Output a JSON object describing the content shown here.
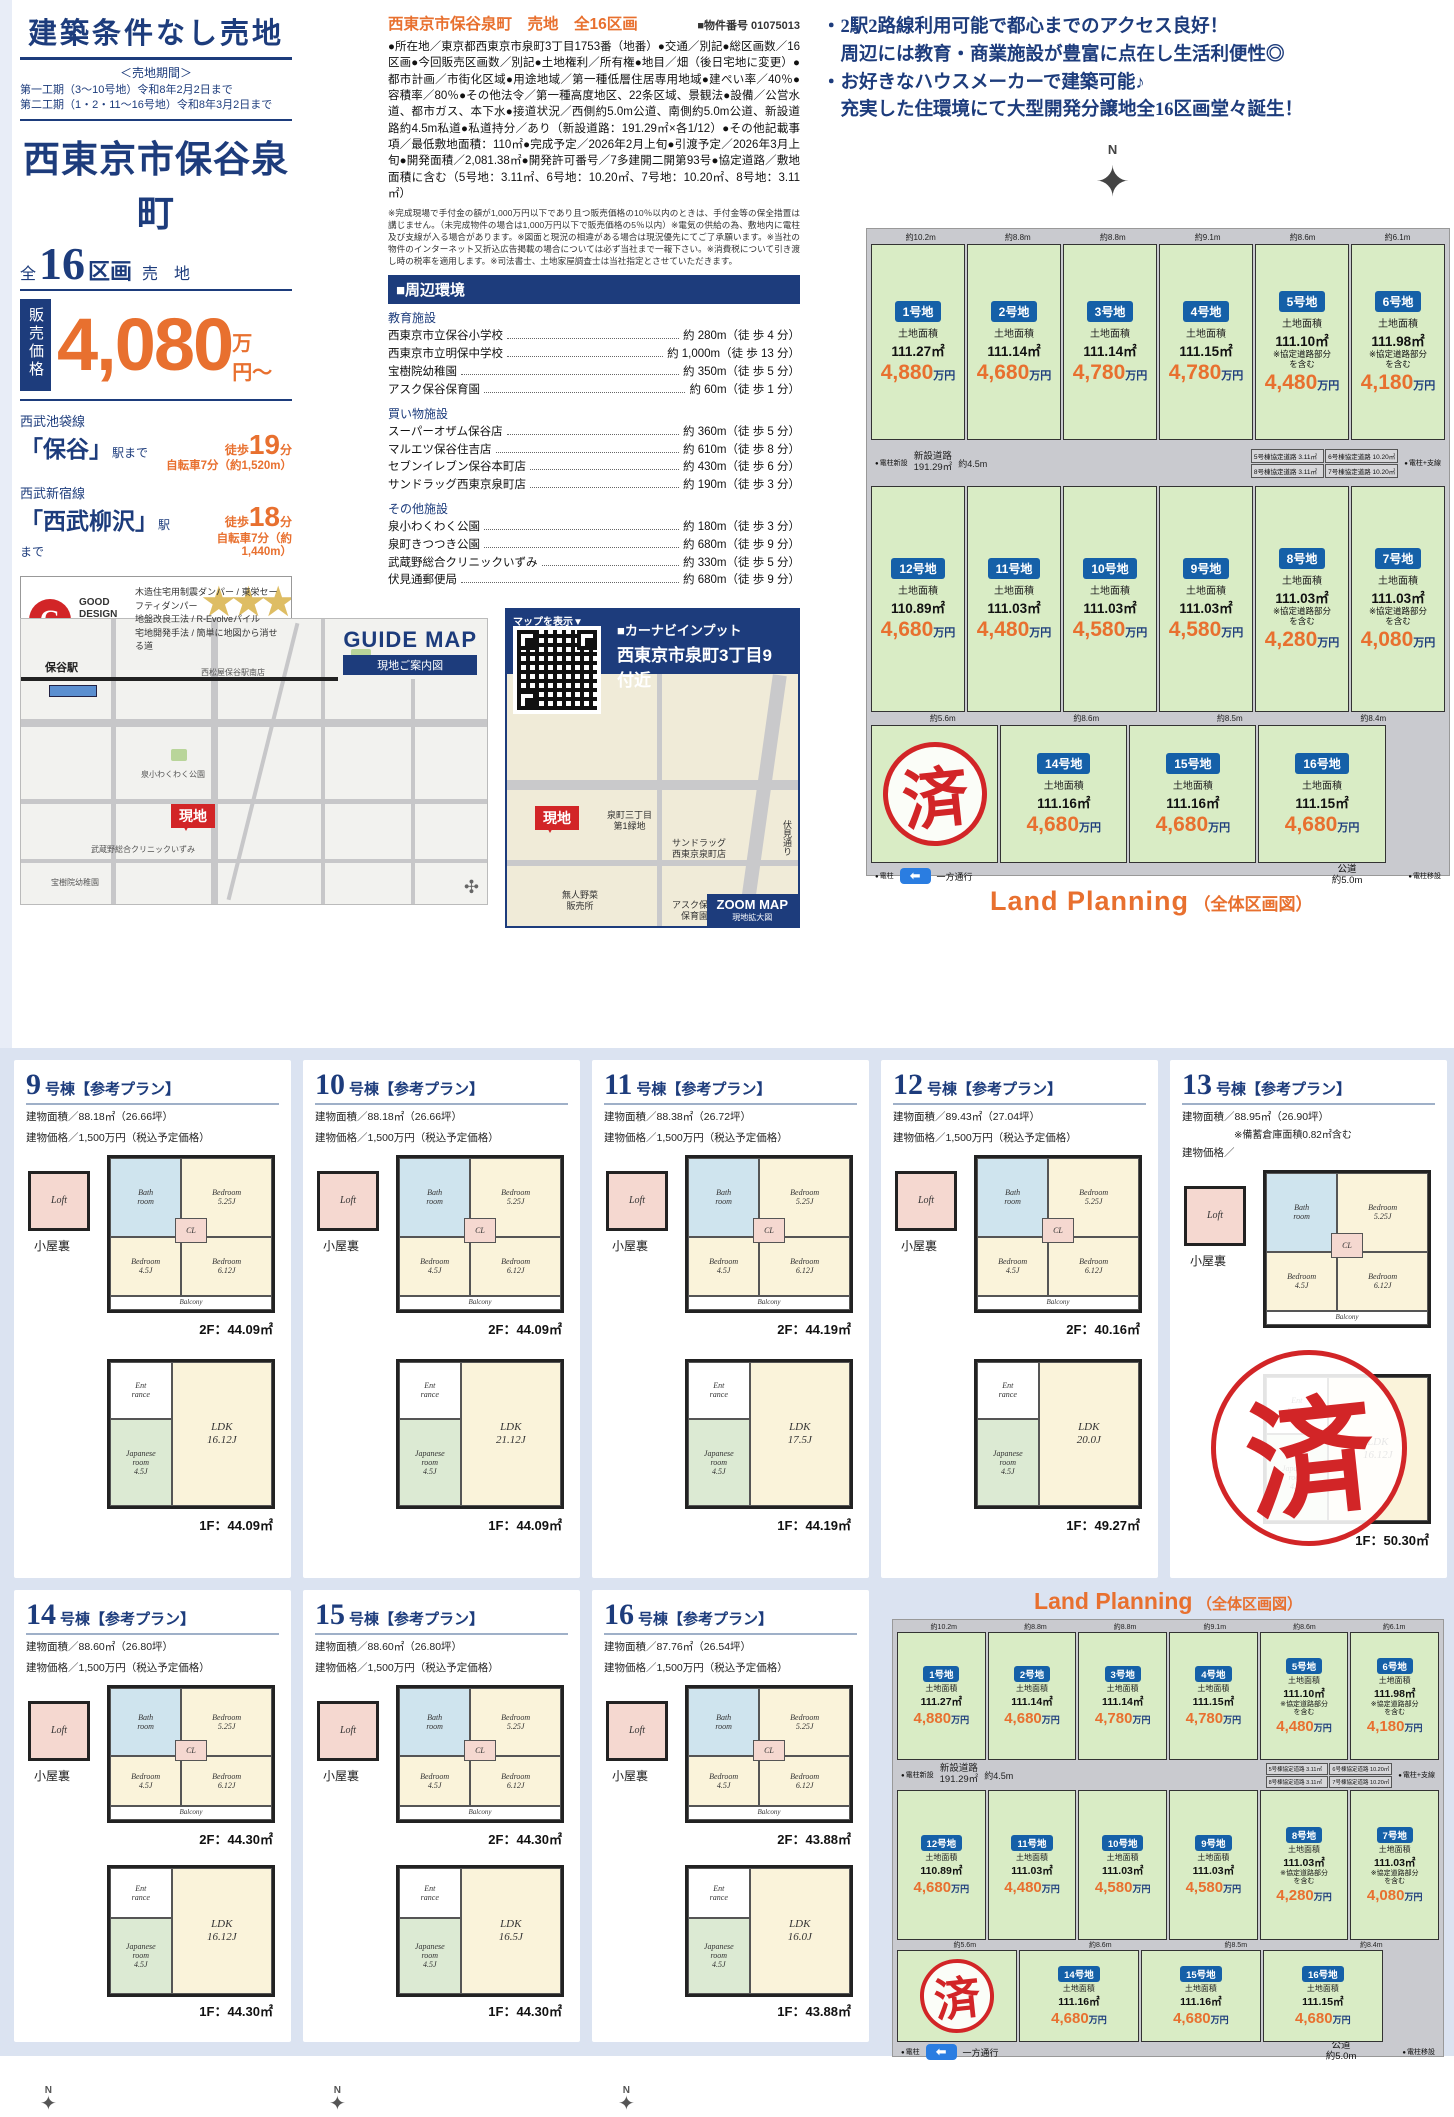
{
  "left": {
    "title": "建築条件なし売地",
    "period_label": "＜売地期間＞",
    "periods": "第一工期（3〜10号地）令和8年2月2日まで\n第二工期（1・2・11〜16号地）令和8年3月2日まで",
    "city": "西東京市保谷泉町",
    "zen": "全",
    "count": "16",
    "kukaku": "区画",
    "urichi": "売 地",
    "price_label": "販売価格",
    "price": "4,080",
    "price_unit": "万円〜",
    "rails": [
      {
        "line": "西武池袋線",
        "station": "「保谷」",
        "suffix": "駅まで",
        "walk_label": "徒歩",
        "walk": "19",
        "min": "分",
        "bike": "自転車7分（約1,520m）"
      },
      {
        "line": "西武新宿線",
        "station": "「西武柳沢」",
        "suffix": "駅まで",
        "walk_label": "徒歩",
        "walk": "18",
        "min": "分",
        "bike": "自転車7分（約1,440m）"
      }
    ],
    "award": {
      "logo": "G",
      "name": "GOOD\nDESIGN\nAWARD\n2024",
      "items": "木造住宅用制震ダンパー / 東栄セーフティダンパー\n地盤改良工法 / R-Evolveパイル\n宅地開発手法 / 簡単に地図から消せる道",
      "stars": "★★★"
    },
    "guide_map": {
      "title": "GUIDE MAP",
      "subtitle": "現地ご案内図",
      "station": "保谷駅",
      "site": "現地",
      "labels": [
        "泉小わくわく公園",
        "武蔵野総合クリニックいずみ",
        "西松屋保谷駅南店",
        "宝樹院幼稚園"
      ],
      "compass": "✣"
    }
  },
  "mid": {
    "header": "西東京市保谷泉町　売地　全16区画",
    "property_no": "■物件番号 01075013",
    "details": "●所在地／東京都西東京市泉町3丁目1753番（地番）●交通／別記●総区画数／16区画●今回販売区画数／別記●土地権利／所有権●地目／畑（後日宅地に変更）●都市計画／市街化区域●用途地域／第一種低層住居専用地域●建ぺい率／40％●容積率／80％●その他法令／第一種高度地区、22条区域、景観法●設備／公営水道、都市ガス、本下水●接道状況／西側約5.0m公道、南側約5.0m公道、新設道路約4.5m私道●私道持分／あり（新設道路：191.29㎡×各1/12）●その他記載事項／最低敷地面積：110㎡●完成予定／2026年2月上旬●引渡予定／2026年3月上旬●開発面積／2,081.38㎡●開発許可番号／7多建開二開第93号●協定道路／敷地面積に含む（5号地：3.11㎡、6号地：10.20㎡、7号地：10.20㎡、8号地：3.11㎡）",
    "disclaimer": "※完成現場で手付金の額が1,000万円以下であり且つ販売価格の10％以内のときは、手付金等の保全措置は講じません。（未完成物件の場合は1,000万円以下で販売価格の5％以内）※電気の供給の為、敷地内に電柱及び支線が入る場合があります。※図面と現況の相違がある場合は現況優先にてご了承願います。※当社の物件のインターネット又折込広告掲載の場合については必ず当社まで一報下さい。※消費税について引き渡し時の税率を適用します。※司法書士、土地家屋調査士は当社指定とさせていただきます。",
    "env_title": "■周辺環境",
    "categories": [
      {
        "name": "教育施設",
        "items": [
          {
            "name": "西東京市立保谷小学校",
            "dist": "約 280m（徒 歩 4 分）"
          },
          {
            "name": "西東京市立明保中学校",
            "dist": "約 1,000m（徒 歩 13 分）"
          },
          {
            "name": "宝樹院幼稚園",
            "dist": "約 350m（徒 歩 5 分）"
          },
          {
            "name": "アスク保谷保育園",
            "dist": "約 60m（徒 歩 1 分）"
          }
        ]
      },
      {
        "name": "買い物施設",
        "items": [
          {
            "name": "スーパーオザム保谷店",
            "dist": "約 360m（徒 歩 5 分）"
          },
          {
            "name": "マルエツ保谷住吉店",
            "dist": "約 610m（徒 歩 8 分）"
          },
          {
            "name": "セブンイレブン保谷本町店",
            "dist": "約 430m（徒 歩 6 分）"
          },
          {
            "name": "サンドラッグ西東京泉町店",
            "dist": "約 190m（徒 歩 3 分）"
          }
        ]
      },
      {
        "name": "その他施設",
        "items": [
          {
            "name": "泉小わくわく公園",
            "dist": "約 180m（徒 歩 3 分）"
          },
          {
            "name": "泉町きつつき公園",
            "dist": "約 680m（徒 歩 9 分）"
          },
          {
            "name": "武蔵野総合クリニックいずみ",
            "dist": "約 330m（徒 歩 5 分）"
          },
          {
            "name": "伏見通郵便局",
            "dist": "約 680m（徒 歩 9 分）"
          }
        ]
      }
    ],
    "zoom_map": {
      "show": "マップを表示▼",
      "carnavi": "■カーナビインプット",
      "address": "西東京市泉町3丁目9 付近",
      "labels": [
        "泉町三丁目\n第1緑地",
        "サンドラッグ\n西東京泉町店",
        "アスク保谷\n保育園",
        "伏見通り",
        "無人野菜\n販売所"
      ],
      "site": "現地",
      "badge": "ZOOM MAP",
      "badge_sub": "現地拡大図"
    }
  },
  "right_header": "・2駅2路線利用可能で都心までのアクセス良好！\n　周辺には教育・商業施設が豊富に点在し生活利便性◎\n・お好きなハウスメーカーで建築可能♪\n　充実した住環境にて大型開発分譲地全16区画堂々誕生！",
  "compass_n": "N",
  "compass_glyph": "✦",
  "map": {
    "title_en": "Land Planning",
    "title_jp": "（全体区画図）",
    "area_label": "土地面積",
    "note": "※協定道路部分\nを含む",
    "price_unit": "万円",
    "sold_mark": "済",
    "road_new": "新設道路\n191.29㎡",
    "road_new_w": "約4.5m",
    "road_public": "公道\n約5.0m",
    "one_way": "一方通行",
    "arrow": "⬅",
    "kyotei": [
      "5号棟協定道路 3.11㎡",
      "6号棟協定道路 10.20㎡",
      "8号棟協定道路 3.11㎡",
      "7号棟協定道路 10.20㎡"
    ],
    "top_dims": [
      "約10.2m",
      "約8.8m",
      "約8.8m",
      "約9.1m",
      "約8.6m",
      "約6.1m"
    ],
    "bottom_dims": [
      "約5.6m",
      "約8.6m",
      "約8.5m",
      "約8.4m"
    ],
    "pole_new": "電柱新設",
    "pole_wire": "電柱+支線",
    "pole": "電柱",
    "pole_move": "電柱移設",
    "plots": [
      {
        "name": "1号地",
        "area": "111.27㎡",
        "price": "4,880"
      },
      {
        "name": "2号地",
        "area": "111.14㎡",
        "price": "4,680"
      },
      {
        "name": "3号地",
        "area": "111.14㎡",
        "price": "4,780"
      },
      {
        "name": "4号地",
        "area": "111.15㎡",
        "price": "4,780"
      },
      {
        "name": "5号地",
        "area": "111.10㎡",
        "note": true,
        "price": "4,480"
      },
      {
        "name": "6号地",
        "area": "111.98㎡",
        "note": true,
        "price": "4,180"
      },
      {
        "name": "7号地",
        "area": "111.03㎡",
        "note": true,
        "price": "4,080"
      },
      {
        "name": "8号地",
        "area": "111.03㎡",
        "note": true,
        "price": "4,280"
      },
      {
        "name": "9号地",
        "area": "111.03㎡",
        "price": "4,580"
      },
      {
        "name": "10号地",
        "area": "111.03㎡",
        "price": "4,580"
      },
      {
        "name": "11号地",
        "area": "111.03㎡",
        "price": "4,480"
      },
      {
        "name": "12号地",
        "area": "110.89㎡",
        "price": "4,680"
      },
      {
        "name": "13号地",
        "sold": true
      },
      {
        "name": "14号地",
        "area": "111.16㎡",
        "price": "4,680"
      },
      {
        "name": "15号地",
        "area": "111.16㎡",
        "price": "4,680"
      },
      {
        "name": "16号地",
        "area": "111.15㎡",
        "price": "4,680"
      }
    ]
  },
  "plan_rooms": {
    "loft": "Loft",
    "loft_caption": "小屋裏",
    "bath": "Bath\nroom",
    "bed1": "Bedroom\n5.25J",
    "bed2": "Bedroom\n4.5J",
    "bed3": "Bedroom\n6.12J",
    "cl": "CL",
    "balcony": "Balcony",
    "entrance": "Ent\nrance",
    "jp_room": "Japanese\nroom\n4.5J"
  },
  "plans": [
    {
      "no": "9",
      "title": "号棟【参考プラン】",
      "area": "建物面積／88.18㎡（26.66坪）",
      "price": "建物価格／1,500万円（税込予定価格）",
      "ldk": "LDK\n16.12J",
      "f2": "2F：44.09㎡",
      "f1": "1F：44.09㎡"
    },
    {
      "no": "10",
      "title": "号棟【参考プラン】",
      "area": "建物面積／88.18㎡（26.66坪）",
      "price": "建物価格／1,500万円（税込予定価格）",
      "ldk": "LDK\n21.12J",
      "f2": "2F：44.09㎡",
      "f1": "1F：44.09㎡"
    },
    {
      "no": "11",
      "title": "号棟【参考プラン】",
      "area": "建物面積／88.38㎡（26.72坪）",
      "price": "建物価格／1,500万円（税込予定価格）",
      "ldk": "LDK\n17.5J",
      "f2": "2F：44.19㎡",
      "f1": "1F：44.19㎡"
    },
    {
      "no": "12",
      "title": "号棟【参考プラン】",
      "area": "建物面積／89.43㎡（27.04坪）",
      "price": "建物価格／1,500万円（税込予定価格）",
      "ldk": "LDK\n20.0J",
      "f2": "2F：40.16㎡",
      "f1": "1F：49.27㎡"
    },
    {
      "no": "13",
      "title": "号棟【参考プラン】",
      "area": "建物面積／88.95㎡（26.90坪）",
      "note": "※備蓄倉庫面積0.82㎡含む",
      "price": "建物価格／",
      "ldk": "LDK\n16.12J",
      "f1": "1F：50.30㎡",
      "sold": true
    },
    {
      "no": "14",
      "title": "号棟【参考プラン】",
      "area": "建物面積／88.60㎡（26.80坪）",
      "price": "建物価格／1,500万円（税込予定価格）",
      "ldk": "LDK\n16.12J",
      "f2": "2F：44.30㎡",
      "f1": "1F：44.30㎡"
    },
    {
      "no": "15",
      "title": "号棟【参考プラン】",
      "area": "建物面積／88.60㎡（26.80坪）",
      "price": "建物価格／1,500万円（税込予定価格）",
      "ldk": "LDK\n16.5J",
      "f2": "2F：44.30㎡",
      "f1": "1F：44.30㎡"
    },
    {
      "no": "16",
      "title": "号棟【参考プラン】",
      "area": "建物面積／87.76㎡（26.54坪）",
      "price": "建物価格／1,500万円（税込予定価格）",
      "ldk": "LDK\n16.0J",
      "f2": "2F：43.88㎡",
      "f1": "1F：43.88㎡"
    }
  ]
}
